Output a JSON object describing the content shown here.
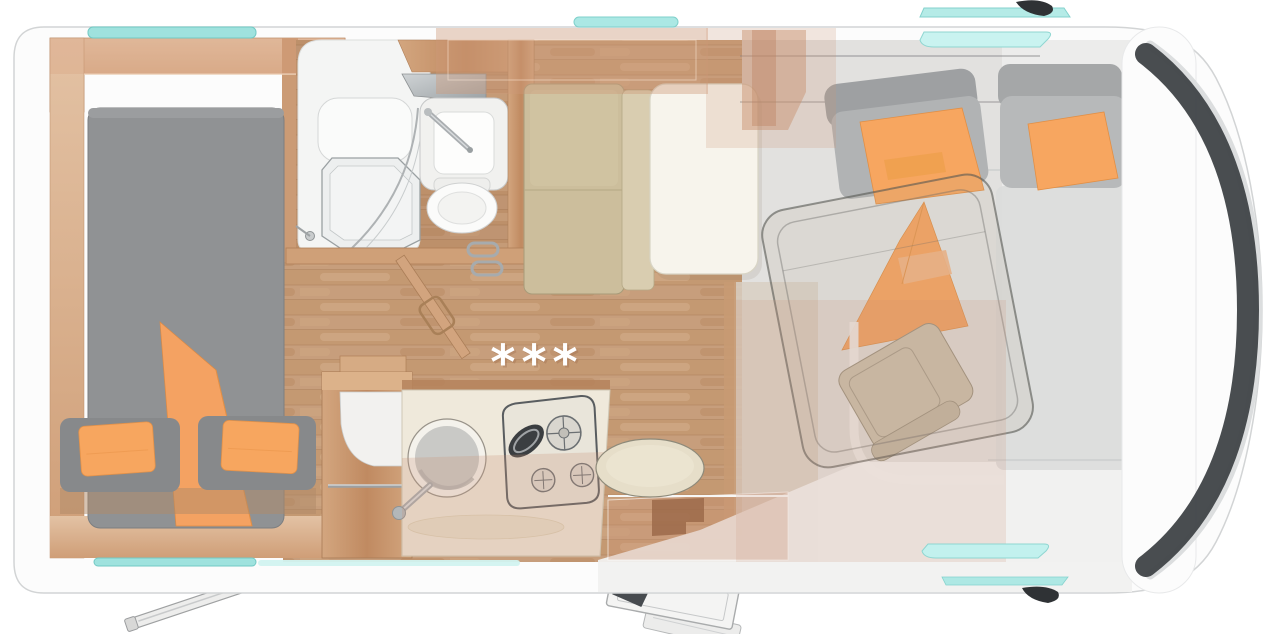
{
  "scene": {
    "title": "Motorhome floor plan, top-down view",
    "view": "top-down",
    "marks": {
      "stars": "***"
    }
  },
  "palette": {
    "body_white": "#fcfcfc",
    "outline_gray": "#d2d4d5",
    "windshield_dark": "#3f4347",
    "window_teal": "#9fe2de",
    "window_teal_light": "#c9f3f0",
    "wood_floor": "#c79e7c",
    "wood_furniture": "#c98f63",
    "mattress_gray": "#8f9193",
    "cushion_orange": "#f6a55f",
    "bench_beige": "#cdbf9d",
    "table_cream": "#f6f3ea",
    "cab_floor_gray": "#e7e7e6",
    "mirror_black": "#2f3235"
  },
  "fixtures": [
    "rear-bed",
    "bed-blanket",
    "bed-pillows",
    "bathroom",
    "shower",
    "washbasin",
    "toilet",
    "bathroom-mirror",
    "bathroom-door",
    "wardrobe",
    "kitchen-counter",
    "kitchen-sink",
    "stove",
    "dinette-bench",
    "dinette-table",
    "entry-stool",
    "entry-step",
    "entry-door",
    "cab-seat-left",
    "cab-seat-right",
    "drop-down-bed",
    "driver-seat",
    "awning-arm",
    "wing-mirror-top",
    "wing-mirror-bottom",
    "windshield",
    "roof-window-rear",
    "roof-window-mid",
    "cab-window-top",
    "cab-window-bottom",
    "heating-mark"
  ]
}
